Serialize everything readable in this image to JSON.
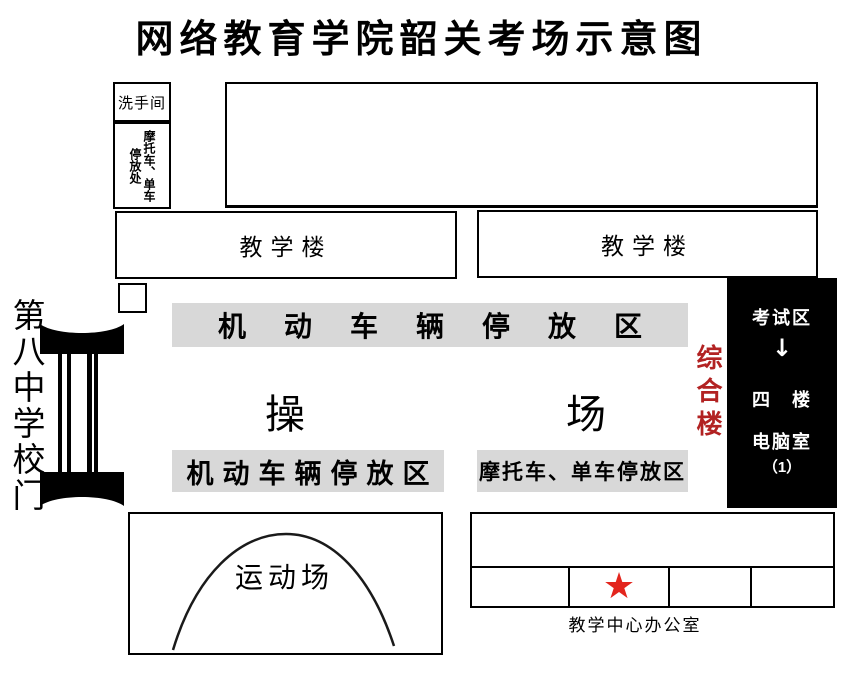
{
  "title": "网络教育学院韶关考场示意图",
  "colors": {
    "parking_bar_bg": "#d8d8d8",
    "exam_block_bg": "#000000",
    "building_red": "#b22222",
    "star_red": "#e3251d"
  },
  "top_left": {
    "washroom_label": "洗手间",
    "moto_bike_parking_line1": "摩托车、单车",
    "moto_bike_parking_line2": "停放处"
  },
  "buildings": {
    "teaching_left_label": "教学楼",
    "teaching_right_label": "教学楼"
  },
  "parking_zones": {
    "motor_top_label": "机动车辆停放区",
    "motor_bottom_label": "机动车辆停放区",
    "moto_bike_bottom_label": "摩托车、单车停放区"
  },
  "playground": {
    "char_left": "操",
    "char_right": "场"
  },
  "school_gate": {
    "label": "第八中学校门"
  },
  "exam_building": {
    "building_label": "综合楼",
    "exam_area_label": "考试区",
    "arrow": "↓",
    "floor_label": "四　楼",
    "room_label": "电脑室",
    "room_number": "（1）"
  },
  "sports_field": {
    "label": "运动场"
  },
  "office_row": {
    "star": "★",
    "office_label": "教学中心办公室"
  }
}
